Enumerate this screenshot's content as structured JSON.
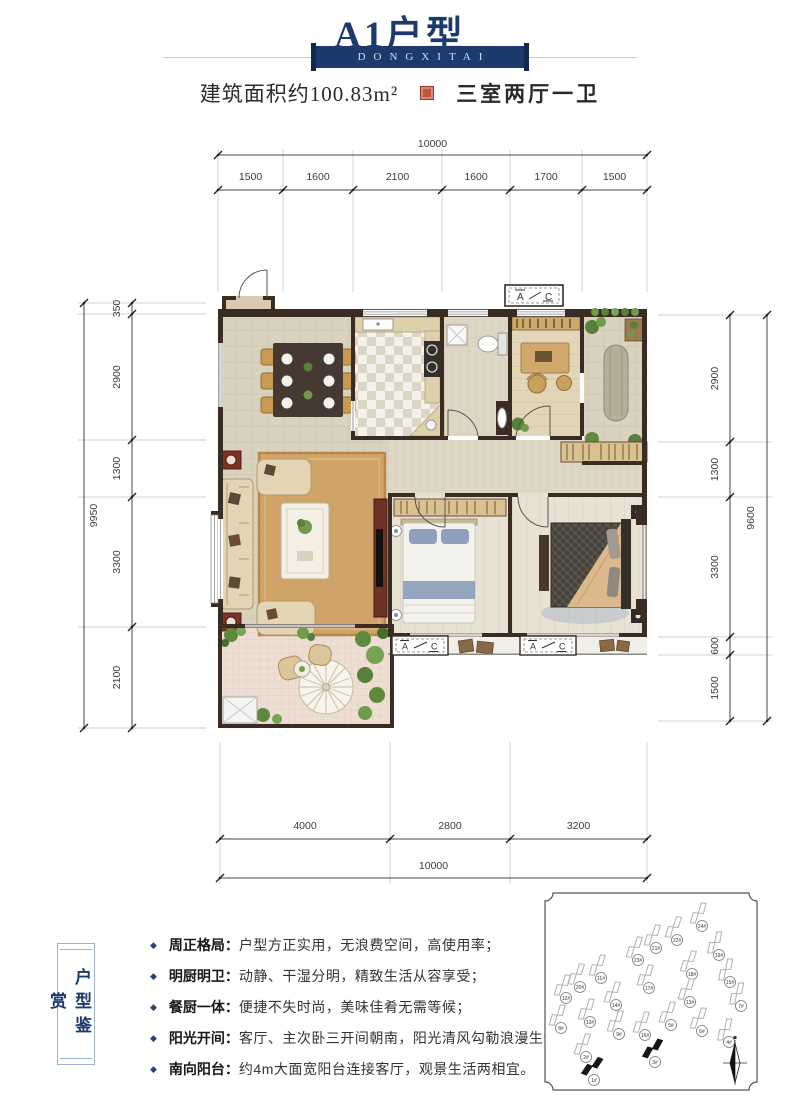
{
  "header": {
    "title": "A1户型",
    "banner": "DONGXITAI",
    "area_label": "建筑面积约100.83m²",
    "layout_label": "三室两厅一卫"
  },
  "dimensions": {
    "top": {
      "total": "10000",
      "segments": [
        "1500",
        "1600",
        "2100",
        "1600",
        "1700",
        "1500"
      ]
    },
    "bottom": {
      "total": "10000",
      "segments": [
        "4000",
        "2800",
        "3200"
      ]
    },
    "left": {
      "total": "9950",
      "segments": [
        "350",
        "2900",
        "1300",
        "3300",
        "2100"
      ]
    },
    "right": {
      "total": "9600",
      "segments": [
        "2900",
        "1300",
        "3300",
        "600",
        "1500"
      ]
    }
  },
  "plan": {
    "ac_a": "A",
    "ac_c": "C"
  },
  "features": {
    "side_label": "户型鉴赏",
    "items": [
      {
        "title": "周正格局：",
        "desc": "户型方正实用，无浪费空间，高使用率；"
      },
      {
        "title": "明厨明卫：",
        "desc": "动静、干湿分明，精致生活从容享受；"
      },
      {
        "title": "餐厨一体：",
        "desc": "便捷不失时尚，美味佳肴无需等候；"
      },
      {
        "title": "阳光开间：",
        "desc": "客厅、主次卧三开间朝南，阳光清风勾勒浪漫生活；"
      },
      {
        "title": "南向阳台：",
        "desc": "约4m大面宽阳台连接客厅，观景生活两相宜。"
      }
    ]
  },
  "site_plan": {
    "buildings": [
      {
        "x": 157,
        "y": 26,
        "rot": -32,
        "label": "24#",
        "filled": false
      },
      {
        "x": 132,
        "y": 40,
        "rot": -32,
        "label": "22#",
        "filled": false
      },
      {
        "x": 111,
        "y": 48,
        "rot": -32,
        "label": "21#",
        "filled": false
      },
      {
        "x": 174,
        "y": 55,
        "rot": -38,
        "label": "19#",
        "filled": false
      },
      {
        "x": 93,
        "y": 60,
        "rot": -32,
        "label": "23#",
        "filled": false
      },
      {
        "x": 147,
        "y": 74,
        "rot": -32,
        "label": "18#",
        "filled": false
      },
      {
        "x": 185,
        "y": 82,
        "rot": -38,
        "label": "15#",
        "filled": false
      },
      {
        "x": 56,
        "y": 78,
        "rot": -32,
        "label": "11#",
        "filled": false
      },
      {
        "x": 35,
        "y": 87,
        "rot": -32,
        "label": "20#",
        "filled": false
      },
      {
        "x": 21,
        "y": 98,
        "rot": -32,
        "label": "12#",
        "filled": false
      },
      {
        "x": 104,
        "y": 88,
        "rot": -32,
        "label": "17#",
        "filled": false
      },
      {
        "x": 71,
        "y": 105,
        "rot": -32,
        "label": "14#",
        "filled": false
      },
      {
        "x": 145,
        "y": 102,
        "rot": -32,
        "label": "13#",
        "filled": false
      },
      {
        "x": 196,
        "y": 106,
        "rot": -38,
        "label": "7#",
        "filled": false
      },
      {
        "x": 45,
        "y": 122,
        "rot": -32,
        "label": "10#",
        "filled": false
      },
      {
        "x": 16,
        "y": 128,
        "rot": -32,
        "label": "8#",
        "filled": false
      },
      {
        "x": 74,
        "y": 134,
        "rot": -32,
        "label": "9#",
        "filled": false
      },
      {
        "x": 100,
        "y": 135,
        "rot": -32,
        "label": "16#",
        "filled": false
      },
      {
        "x": 126,
        "y": 125,
        "rot": -32,
        "label": "5#",
        "filled": false
      },
      {
        "x": 157,
        "y": 131,
        "rot": -32,
        "label": "6#",
        "filled": false
      },
      {
        "x": 184,
        "y": 142,
        "rot": -38,
        "label": "4#",
        "filled": false
      },
      {
        "x": 41,
        "y": 157,
        "rot": -32,
        "label": "2#",
        "filled": false
      },
      {
        "x": 110,
        "y": 162,
        "rot": -20,
        "label": "3#",
        "filled": true
      },
      {
        "x": 49,
        "y": 180,
        "rot": -15,
        "label": "1#",
        "filled": true
      }
    ]
  }
}
